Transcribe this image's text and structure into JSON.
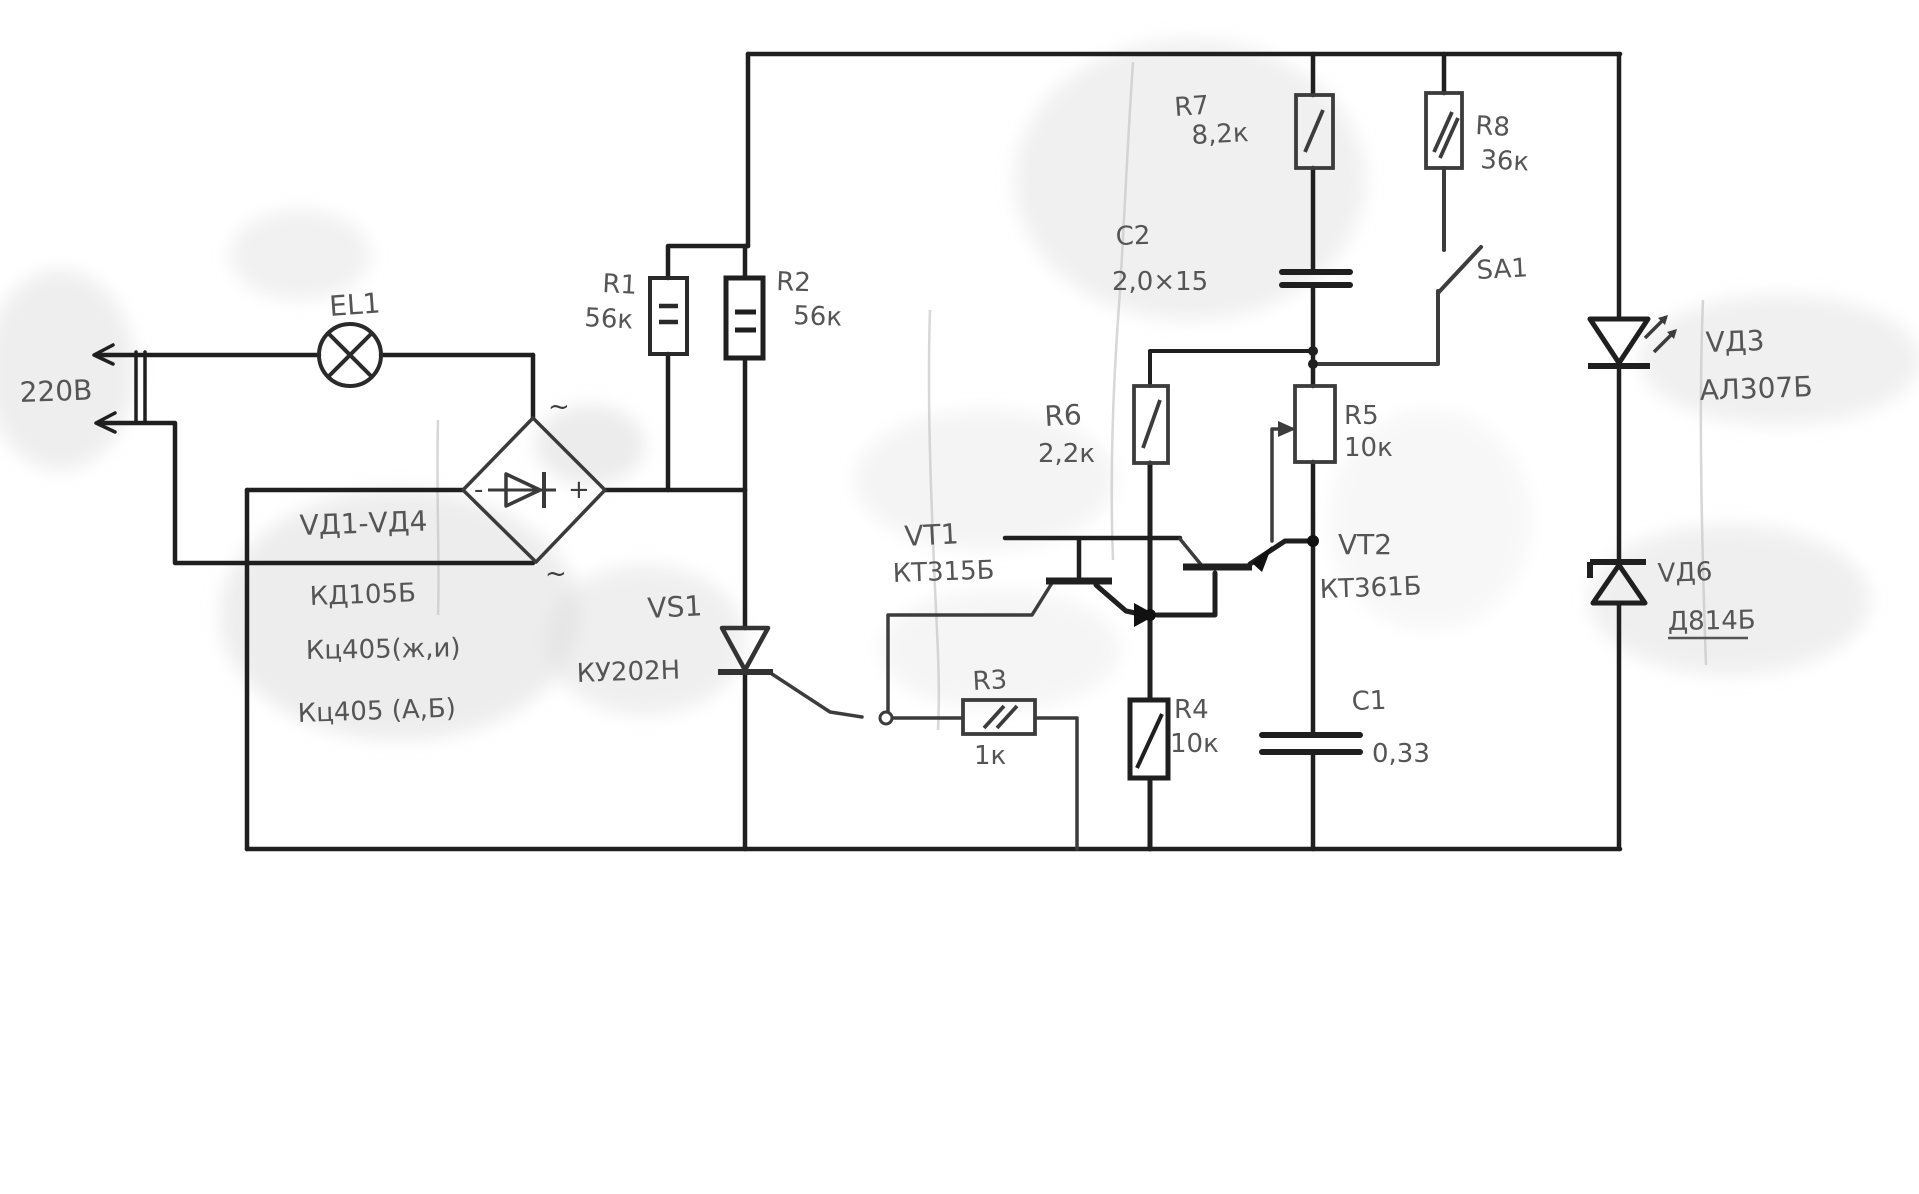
{
  "schematic": {
    "mains": {
      "voltage_label": "220В"
    },
    "lamp": {
      "ref": "EL1"
    },
    "bridge": {
      "ref": "VД1-VД4",
      "type_line1": "КД105Б",
      "type_line2": "Кц405(ж,и)",
      "type_line3": "Кц405 (А,Б)",
      "plus": "+",
      "minus": "-",
      "ac_top": "~",
      "ac_bottom": "~"
    },
    "resistors": {
      "r1": {
        "ref": "R1",
        "value": "56к"
      },
      "r2": {
        "ref": "R2",
        "value": "56к"
      },
      "r3": {
        "ref": "R3",
        "value": "1к"
      },
      "r4": {
        "ref": "R4",
        "value": "10к"
      },
      "r5": {
        "ref": "R5",
        "value": "10к"
      },
      "r6": {
        "ref": "R6",
        "value": "2,2к"
      },
      "r7": {
        "ref": "R7",
        "value": "8,2к"
      },
      "r8": {
        "ref": "R8",
        "value": "36к"
      }
    },
    "capacitors": {
      "c1": {
        "ref": "C1",
        "value": "0,33"
      },
      "c2": {
        "ref": "C2",
        "value": "2,0×15"
      }
    },
    "thyristor": {
      "ref": "VS1",
      "type": "КУ202Н"
    },
    "transistors": {
      "vt1": {
        "ref": "VT1",
        "type": "КТ315Б"
      },
      "vt2": {
        "ref": "VT2",
        "type": "КТ361Б"
      }
    },
    "led": {
      "ref": "VД3",
      "type": "АЛ307Б"
    },
    "zener": {
      "ref": "VД6",
      "type": "Д814Б"
    },
    "switch": {
      "ref": "SA1"
    },
    "colors": {
      "ink": "#1f1f1f",
      "pencil": "#555555",
      "paper": "#ffffff"
    }
  }
}
